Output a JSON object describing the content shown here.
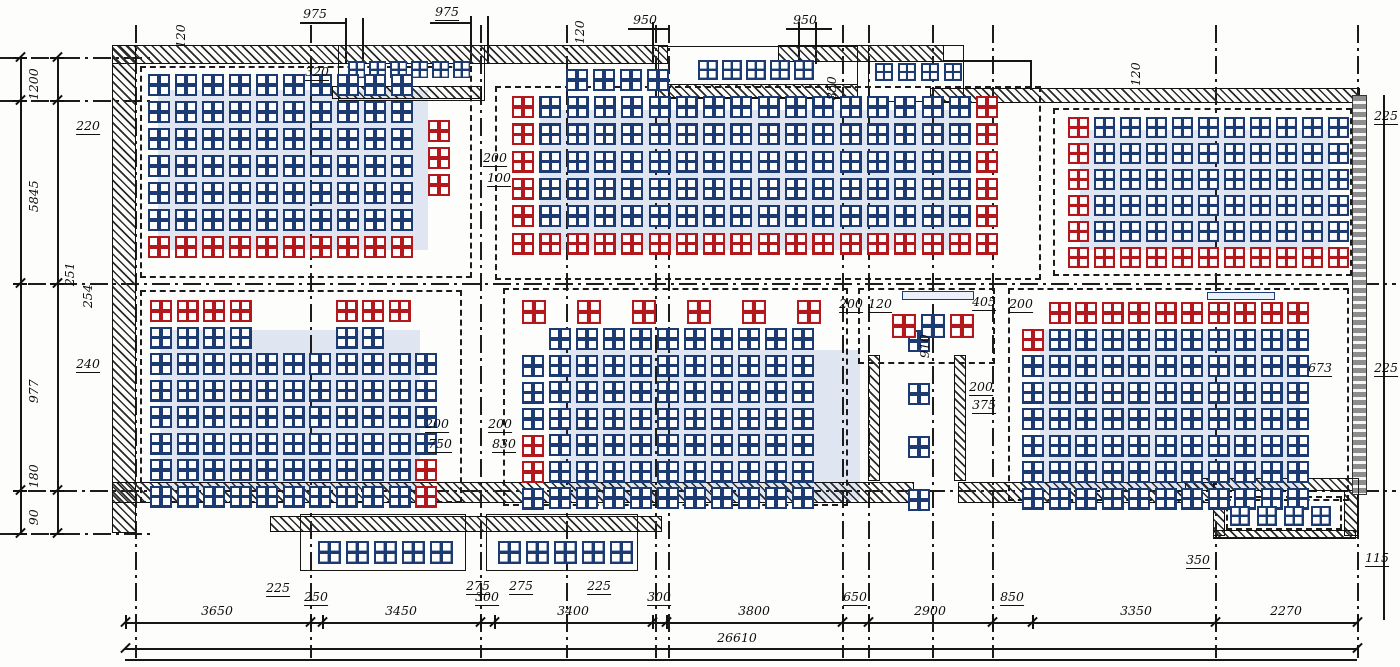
{
  "drawing": {
    "type": "structural floor plan with block (panel) layout",
    "overall_dimension": "26610"
  },
  "colors": {
    "block_blue": "#1d3b73",
    "block_red": "#b3191c",
    "ink": "#161616",
    "highlight": "rgba(90,125,195,0.18)"
  },
  "walls": [
    [
      112,
      45,
      556,
      19
    ],
    [
      112,
      45,
      24,
      488
    ],
    [
      332,
      86,
      150,
      13
    ],
    [
      658,
      84,
      200,
      14
    ],
    [
      778,
      45,
      166,
      17
    ],
    [
      930,
      88,
      430,
      15
    ],
    [
      868,
      355,
      12,
      126
    ],
    [
      954,
      355,
      12,
      126
    ],
    [
      112,
      482,
      802,
      21
    ],
    [
      958,
      482,
      257,
      21
    ],
    [
      270,
      516,
      392,
      16
    ],
    [
      1185,
      478,
      175,
      13
    ],
    [
      1213,
      490,
      12,
      46
    ],
    [
      1344,
      490,
      14,
      46
    ],
    [
      1213,
      530,
      143,
      9
    ]
  ],
  "gray_walls": [
    [
      1352,
      95,
      15,
      400
    ]
  ],
  "outlines": [
    [
      300,
      514,
      166,
      57
    ],
    [
      486,
      514,
      152,
      57
    ],
    [
      658,
      46,
      200,
      53
    ],
    [
      338,
      45,
      147,
      56
    ],
    [
      868,
      45,
      96,
      57
    ],
    [
      1213,
      478,
      146,
      60
    ]
  ],
  "bars": [
    [
      902,
      291,
      72,
      9
    ],
    [
      1207,
      292,
      68,
      8
    ]
  ],
  "dashed_rooms": [
    [
      140,
      66,
      332,
      212
    ],
    [
      495,
      86,
      546,
      194
    ],
    [
      1053,
      108,
      299,
      168
    ],
    [
      140,
      290,
      322,
      213
    ],
    [
      503,
      288,
      345,
      218
    ],
    [
      858,
      288,
      137,
      76
    ],
    [
      1008,
      288,
      341,
      213
    ],
    [
      1226,
      496,
      116,
      34
    ]
  ],
  "backdrops": [
    [
      158,
      90,
      270,
      160
    ],
    [
      540,
      110,
      430,
      140
    ],
    [
      1080,
      130,
      250,
      120
    ],
    [
      160,
      330,
      260,
      160
    ],
    [
      560,
      350,
      300,
      150
    ],
    [
      1040,
      330,
      260,
      160
    ]
  ],
  "gridlines_v": [
    [
      135,
      25,
      658
    ],
    [
      310,
      25,
      658
    ],
    [
      480,
      25,
      658
    ],
    [
      566,
      25,
      658
    ],
    [
      655,
      25,
      658
    ],
    [
      668,
      25,
      658
    ],
    [
      842,
      25,
      658
    ],
    [
      868,
      25,
      658
    ],
    [
      932,
      25,
      658
    ],
    [
      992,
      25,
      658
    ],
    [
      1215,
      25,
      658
    ],
    [
      1357,
      25,
      658
    ]
  ],
  "gridlines_h": [
    [
      283,
      28,
      1396
    ],
    [
      490,
      28,
      1396
    ],
    [
      57,
      0,
      150
    ],
    [
      100,
      0,
      150
    ],
    [
      533,
      0,
      150
    ]
  ],
  "solid_lines": [
    [
      300,
      22,
      46,
      1.5
    ],
    [
      430,
      22,
      42,
      1.5
    ],
    [
      628,
      28,
      42,
      1.5
    ],
    [
      786,
      28,
      46,
      1.5
    ],
    [
      345,
      18,
      1.5,
      46
    ],
    [
      362,
      18,
      1.5,
      46
    ],
    [
      470,
      16,
      1.5,
      48
    ],
    [
      487,
      16,
      1.5,
      48
    ],
    [
      652,
      22,
      1.5,
      42
    ],
    [
      798,
      22,
      1.5,
      42
    ],
    [
      815,
      22,
      1.5,
      42
    ],
    [
      944,
      60,
      88,
      1.5
    ],
    [
      1030,
      60,
      1.5,
      30
    ],
    [
      1383,
      95,
      1.5,
      525
    ],
    [
      125,
      659,
      1232,
      1.5
    ]
  ],
  "rooms": [
    {
      "name": "bay-top-left",
      "x": 348,
      "y": 61,
      "cols": 6,
      "rows": 1,
      "px": 21,
      "py": 21,
      "size": 17
    },
    {
      "name": "bay-top-mid",
      "x": 698,
      "y": 60,
      "cols": 5,
      "rows": 1,
      "px": 24,
      "py": 24,
      "size": 20
    },
    {
      "name": "bay-top-right",
      "x": 875,
      "y": 63,
      "cols": 4,
      "rows": 1,
      "px": 23,
      "py": 23,
      "size": 18
    },
    {
      "name": "room-upper-left",
      "x": 148,
      "y": 74,
      "cols": 10,
      "rows": 7,
      "px": 27,
      "py": 27,
      "size": 22,
      "red_rows": [
        6
      ]
    },
    {
      "name": "upper-left-red-col",
      "x": 428,
      "y": 120,
      "cols": 1,
      "rows": 3,
      "px": 27,
      "py": 27,
      "size": 22,
      "all_red": true
    },
    {
      "name": "room-upper-mid",
      "x": 512,
      "y": 96,
      "cols": 18,
      "rows": 6,
      "px": 27.3,
      "py": 27.3,
      "size": 22,
      "red_cols": [
        0,
        17
      ],
      "red_rows": [
        5
      ]
    },
    {
      "name": "upper-mid-top-row",
      "x": 566,
      "y": 69,
      "cols": 4,
      "rows": 1,
      "px": 27,
      "py": 27,
      "size": 22
    },
    {
      "name": "room-upper-right",
      "x": 1068,
      "y": 117,
      "cols": 11,
      "rows": 6,
      "px": 26,
      "py": 26,
      "size": 21,
      "red_cols": [
        0
      ],
      "red_rows": [
        5
      ]
    },
    {
      "name": "room-lower-left",
      "x": 150,
      "y": 300,
      "cols": 11,
      "rows": 8,
      "px": 26.5,
      "py": 26.5,
      "size": 22,
      "red_cells": [
        [
          0,
          0
        ],
        [
          0,
          1
        ],
        [
          0,
          2
        ],
        [
          0,
          3
        ],
        [
          0,
          7
        ],
        [
          0,
          8
        ],
        [
          0,
          9
        ],
        [
          6,
          10
        ],
        [
          7,
          10
        ]
      ],
      "skip": [
        [
          0,
          4
        ],
        [
          0,
          5
        ],
        [
          0,
          6
        ],
        [
          0,
          10
        ],
        [
          1,
          4
        ],
        [
          1,
          5
        ],
        [
          1,
          6
        ],
        [
          1,
          9
        ],
        [
          1,
          10
        ]
      ]
    },
    {
      "name": "lower-mid-red-row",
      "x": 522,
      "y": 300,
      "cols": 6,
      "rows": 1,
      "px": 55,
      "py": 27,
      "size": 24,
      "all_red": true
    },
    {
      "name": "room-lower-mid",
      "x": 549,
      "y": 328,
      "cols": 10,
      "rows": 7,
      "px": 27,
      "py": 26.5,
      "size": 22
    },
    {
      "name": "lower-mid-left-col",
      "x": 522,
      "y": 355,
      "cols": 1,
      "rows": 6,
      "px": 27,
      "py": 26.5,
      "size": 22,
      "red_cells": [
        [
          3,
          0
        ],
        [
          4,
          0
        ]
      ]
    },
    {
      "name": "lower-mid-right-col",
      "x": 908,
      "y": 330,
      "cols": 1,
      "rows": 7,
      "px": 27,
      "py": 26.5,
      "size": 22,
      "skip": [
        [
          1,
          0
        ],
        [
          3,
          0
        ],
        [
          5,
          0
        ]
      ]
    },
    {
      "name": "stair-landing-blocks",
      "x": 892,
      "y": 314,
      "cols": 3,
      "rows": 1,
      "px": 29,
      "py": 29,
      "size": 24,
      "red_cells": [
        [
          0,
          0
        ],
        [
          0,
          2
        ]
      ]
    },
    {
      "name": "room-lower-right",
      "x": 1022,
      "y": 302,
      "cols": 11,
      "rows": 8,
      "px": 26.5,
      "py": 26.5,
      "size": 22,
      "red_cells": [
        [
          0,
          1
        ],
        [
          0,
          2
        ],
        [
          0,
          3
        ],
        [
          0,
          4
        ],
        [
          0,
          5
        ],
        [
          0,
          6
        ],
        [
          0,
          7
        ],
        [
          0,
          8
        ],
        [
          0,
          9
        ],
        [
          0,
          10
        ],
        [
          1,
          0
        ]
      ],
      "skip": [
        [
          0,
          0
        ]
      ]
    },
    {
      "name": "annex-blocks",
      "x": 1230,
      "y": 506,
      "cols": 4,
      "rows": 1,
      "px": 27,
      "py": 27,
      "size": 20
    },
    {
      "name": "porch-left-blocks",
      "x": 318,
      "y": 541,
      "cols": 5,
      "rows": 1,
      "px": 28,
      "py": 28,
      "size": 23
    },
    {
      "name": "porch-right-blocks",
      "x": 498,
      "y": 541,
      "cols": 5,
      "rows": 1,
      "px": 28,
      "py": 28,
      "size": 23
    }
  ],
  "dim_bottom": {
    "y": 622,
    "ticks": [
      125,
      310,
      322,
      480,
      494,
      652,
      666,
      842,
      868,
      992,
      1032,
      1215,
      1357
    ],
    "labels": [
      {
        "t": "3650",
        "x": 217
      },
      {
        "t": "250",
        "x": 316,
        "flag": true
      },
      {
        "t": "3450",
        "x": 401
      },
      {
        "t": "300",
        "x": 487,
        "flag": true
      },
      {
        "t": "3400",
        "x": 573
      },
      {
        "t": "300",
        "x": 659,
        "flag": true
      },
      {
        "t": "3800",
        "x": 754
      },
      {
        "t": "650",
        "x": 855,
        "flag": true
      },
      {
        "t": "2900",
        "x": 930
      },
      {
        "t": "850",
        "x": 1012,
        "flag": true
      },
      {
        "t": "3350",
        "x": 1136
      },
      {
        "t": "2270",
        "x": 1286
      }
    ]
  },
  "dim_overall": {
    "y": 648,
    "x0": 125,
    "x1": 1357,
    "label": "26610",
    "lx": 737
  },
  "dim_left": {
    "lines_x": [
      20,
      57
    ],
    "ticks": [
      57,
      100,
      283,
      490,
      533
    ],
    "labels": [
      {
        "t": "1200",
        "y": 78
      },
      {
        "t": "5845",
        "y": 190
      },
      {
        "t": "977",
        "y": 385
      },
      {
        "t": "90",
        "y": 511
      }
    ]
  },
  "labels": [
    {
      "t": "975",
      "x": 315,
      "y": 8,
      "ul": true
    },
    {
      "t": "975",
      "x": 447,
      "y": 6,
      "ul": true
    },
    {
      "t": "950",
      "x": 645,
      "y": 14,
      "ul": true
    },
    {
      "t": "950",
      "x": 805,
      "y": 14,
      "ul": true
    },
    {
      "t": "120",
      "x": 181,
      "y": 30,
      "r": true
    },
    {
      "t": "120",
      "x": 580,
      "y": 26,
      "r": true
    },
    {
      "t": "850",
      "x": 832,
      "y": 82,
      "r": true
    },
    {
      "t": "120",
      "x": 1136,
      "y": 68,
      "r": true
    },
    {
      "t": "320",
      "x": 317,
      "y": 66,
      "ul": true
    },
    {
      "t": "225",
      "x": 1386,
      "y": 110,
      "ul": true
    },
    {
      "t": "220",
      "x": 88,
      "y": 120,
      "ul": true
    },
    {
      "t": "240",
      "x": 88,
      "y": 358,
      "ul": true
    },
    {
      "t": "251",
      "x": 70,
      "y": 268,
      "r": true
    },
    {
      "t": "254",
      "x": 88,
      "y": 290,
      "r": true
    },
    {
      "t": "180",
      "x": 34,
      "y": 470,
      "r": true
    },
    {
      "t": "200",
      "x": 495,
      "y": 152,
      "ul": true
    },
    {
      "t": "100",
      "x": 499,
      "y": 172,
      "ul": true
    },
    {
      "t": "200",
      "x": 851,
      "y": 298,
      "ul": true
    },
    {
      "t": "120",
      "x": 880,
      "y": 298,
      "ul": true
    },
    {
      "t": "405",
      "x": 984,
      "y": 296,
      "ul": true
    },
    {
      "t": "200",
      "x": 1021,
      "y": 298,
      "ul": true
    },
    {
      "t": "910",
      "x": 925,
      "y": 340,
      "r": true
    },
    {
      "t": "200",
      "x": 981,
      "y": 381,
      "ul": true
    },
    {
      "t": "375",
      "x": 984,
      "y": 399,
      "ul": true
    },
    {
      "t": "200",
      "x": 437,
      "y": 418,
      "ul": true
    },
    {
      "t": "750",
      "x": 440,
      "y": 438,
      "ul": true
    },
    {
      "t": "200",
      "x": 500,
      "y": 418,
      "ul": true
    },
    {
      "t": "830",
      "x": 504,
      "y": 438,
      "ul": true
    },
    {
      "t": "673",
      "x": 1320,
      "y": 362,
      "ul": true
    },
    {
      "t": "225",
      "x": 1386,
      "y": 362,
      "ul": true
    },
    {
      "t": "350",
      "x": 1198,
      "y": 554,
      "ul": true
    },
    {
      "t": "115",
      "x": 1377,
      "y": 552,
      "ul": true
    },
    {
      "t": "225",
      "x": 278,
      "y": 582,
      "ul": true
    },
    {
      "t": "275",
      "x": 478,
      "y": 580,
      "ul": true
    },
    {
      "t": "275",
      "x": 521,
      "y": 580,
      "ul": true
    },
    {
      "t": "225",
      "x": 599,
      "y": 580,
      "ul": true
    }
  ]
}
